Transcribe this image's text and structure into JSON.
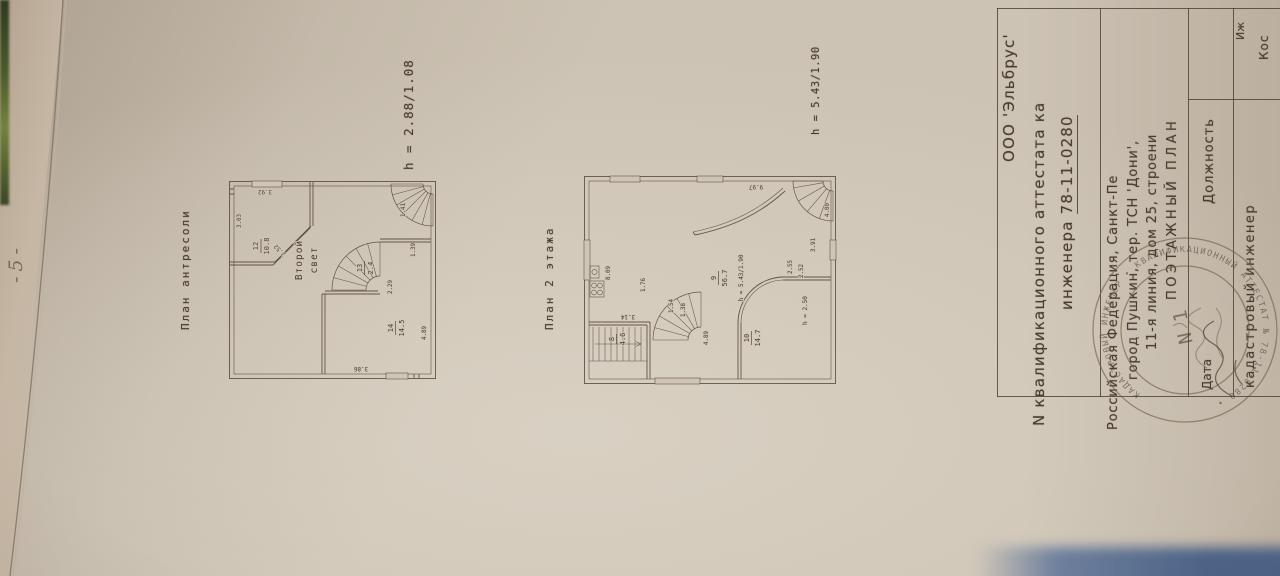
{
  "photo": {
    "page_number": "-5-"
  },
  "plan_antresol": {
    "title": "План антресоли",
    "height_note": "h = 2.88/1.08",
    "void_label_1": "Второй",
    "void_label_2": "свет",
    "room12_num": "12",
    "room12_area": "10.8",
    "room13_num": "13",
    "room13_area": "2.4",
    "room14_num": "14",
    "room14_area": "14.5",
    "dim_303": "3.03",
    "dim_392": "3.92",
    "dim_252": "2.52",
    "dim_141": "1.41",
    "dim_229": "2.29",
    "dim_139": "1.39",
    "dim_489": "4.89",
    "dim_386": "3.86"
  },
  "plan_floor2": {
    "title": "План 2 этажа",
    "height_note": "h = 5.43/1.90",
    "room8_num": "8",
    "room8_area": "4.6",
    "room9_num": "9",
    "room9_area": "56.7",
    "room9_height": "h = 5.43/1.90",
    "room10_num": "10",
    "room10_area": "14.7",
    "room10_height": "h = 2.50",
    "dim_809": "8.09",
    "dim_314": "3.14",
    "dim_176": "1.76",
    "dim_154": "1.54",
    "dim_138": "1.38",
    "dim_489": "4.89",
    "dim_255": "2.55",
    "dim_252": "2.52",
    "dim_391": "3.91",
    "dim_400": "4.00",
    "dim_997": "9.97"
  },
  "title_block": {
    "company": "ООО 'Эльбрус'",
    "attestat_line": "N квалификационного аттестата ка",
    "engineer_prefix": "инженера ",
    "attestat_number": "78-11-0280",
    "address_1": "Российская Федерация, Санкт-Пе",
    "address_2": "город Пушкин, тер. ТСН 'Дони',",
    "address_3": "11-я линия, дом 25, строени",
    "doc_type": "ПОЭТАЖНЫЙ ПЛАН",
    "th_date": "Дата",
    "th_position": "Должность",
    "row_position": "кадастровый инженер",
    "row_name_top": "Иж",
    "row_name": "Кос",
    "stamp_ring": "КАДАСТРОВЫЙ ИНЖЕНЕР  •  КВАЛИФИКАЦИОННЫЙ АТТЕСТАТ № 78-11-0280  •  ",
    "stamp_center": "N 1"
  }
}
